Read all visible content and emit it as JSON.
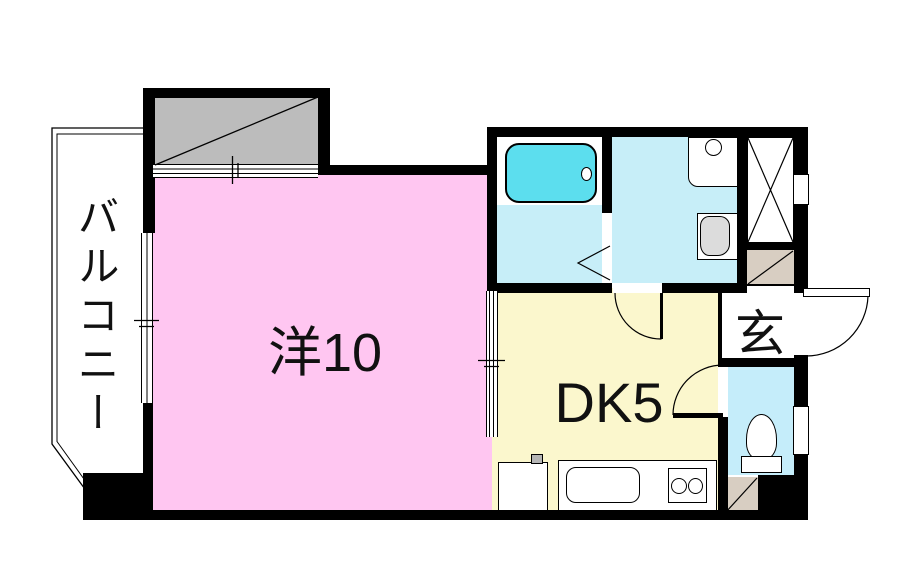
{
  "floor_plan": {
    "labels": {
      "balcony": "バルコニー",
      "western_room": "洋10",
      "dining_kitchen": "DK5",
      "entrance": "玄"
    },
    "colors": {
      "wall": "#000000",
      "western_room_floor": "#FFC6F1",
      "dining_kitchen_floor": "#FBF7CD",
      "bathroom_floor": "#C7EEF8",
      "washroom_floor": "#C7EEF8",
      "toilet_room_floor": "#C5EDFA",
      "bathtub": "#5CDEEE",
      "utility_box": "#BCBCBC",
      "entrance_step": "#D8CEC2",
      "fixture_bowl": "#DCDCDC",
      "background": "#FFFFFF"
    },
    "fixtures": [
      "bathtub",
      "bathtub-drain",
      "washing-machine-pan",
      "vanity-basin",
      "toilet",
      "shoe-cabinet-x",
      "kitchen-counter",
      "kitchen-sink",
      "two-burner-stove",
      "sink-unit-with-tap",
      "entrance-door-swing",
      "toilet-door-swing",
      "washroom-door-swing",
      "folding-bath-door",
      "sliding-partition",
      "balcony-window",
      "utility-diagonal-box",
      "entrance-step-diagonal"
    ]
  }
}
